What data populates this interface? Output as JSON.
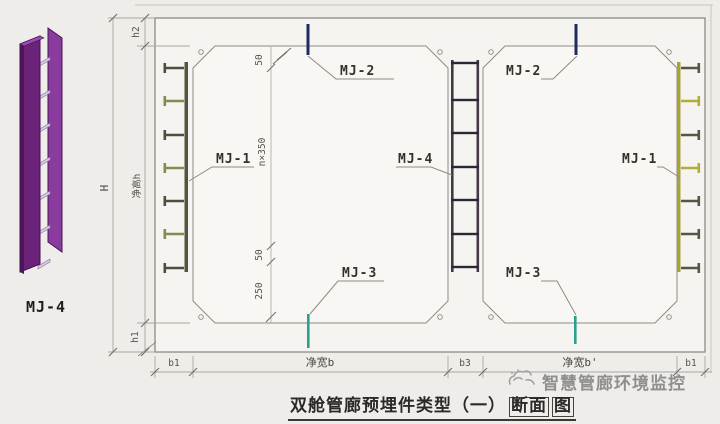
{
  "figure": {
    "label": "MJ-4"
  },
  "callouts": {
    "mj2_left": "MJ-2",
    "mj1_left": "MJ-1",
    "mj3_left": "MJ-3",
    "mj4_center": "MJ-4",
    "mj2_right": "MJ-2",
    "mj1_right": "MJ-1",
    "mj3_right": "MJ-3"
  },
  "dimensions": {
    "overall_height": "H",
    "roof_thickness": "h2",
    "net_height": "净高h",
    "floor_thickness": "h1",
    "bottom_row": {
      "left_wall": "b1",
      "left_span": "净宽b",
      "mid_wall": "b3",
      "right_span": "净宽b'",
      "right_wall": "b1"
    },
    "internal": {
      "top_offset": "50",
      "spacing": "n×350",
      "bottom_offset": "50",
      "clearance": "250"
    }
  },
  "title": {
    "main": "双舱管廊预埋件类型（一）",
    "boxed_a": "断面",
    "boxed_b": "图"
  },
  "watermark": {
    "text": "智慧管廊环境监控"
  },
  "colors": {
    "line": "#8e8b83",
    "mj2_navy": "#1f2a5e",
    "mj3_teal": "#2aa18c",
    "mj1_left_channel": "#55523d",
    "mj1_right_channel": "#a9a23b",
    "mj4_rail": "#453744",
    "mj4_rung": "#2c2637",
    "purple_front": "#6b2379",
    "purple_back": "#8a3b9e"
  }
}
